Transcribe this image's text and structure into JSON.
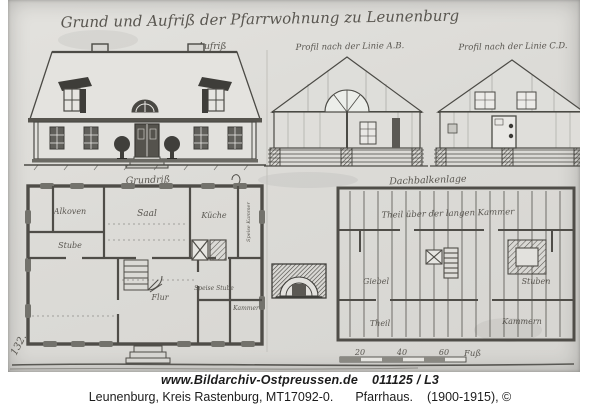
{
  "archive_photo": {
    "title_handwritten": "Grund und Aufriß der Pfarrwohnung zu Leunenburg",
    "elevation": {
      "label": "Aufriß"
    },
    "sections": {
      "ab_label": "Profil nach der Linie A.B.",
      "cd_label": "Profil nach der Linie C.D."
    },
    "ground_plan": {
      "label": "Grundriß",
      "rooms": [
        {
          "name": "Alkoven"
        },
        {
          "name": "Saal"
        },
        {
          "name": "Küche"
        },
        {
          "name": "Stube"
        },
        {
          "name": "Flur"
        },
        {
          "name": "Speise Stube"
        },
        {
          "name": "Kammer"
        },
        {
          "name": "Speise Kammer"
        }
      ]
    },
    "attic_plan": {
      "label": "Dachbalkenlage",
      "note": "Theil über der langen Kammer",
      "areas": [
        {
          "name": "Giebel"
        },
        {
          "name": "Stuben"
        },
        {
          "name": "Theil"
        },
        {
          "name": "Kammern"
        }
      ]
    },
    "scale_bar": {
      "ticks": [
        "20",
        "40",
        "60"
      ],
      "unit": "Fuß"
    },
    "margin_number": "132."
  },
  "caption": {
    "website": "www.Bildarchiv-Ostpreussen.de",
    "image_id": "011125 / L3",
    "location": "Leunenburg, Kreis Rastenburg, MT17092-0.",
    "subject": "Pfarrhaus.",
    "date_copyright": "(1900-1915), ©"
  },
  "colors": {
    "paper": "#dcdbd7",
    "ink": "#4b4a45",
    "caption_text": "#1c1c1c",
    "background": "#ffffff"
  }
}
